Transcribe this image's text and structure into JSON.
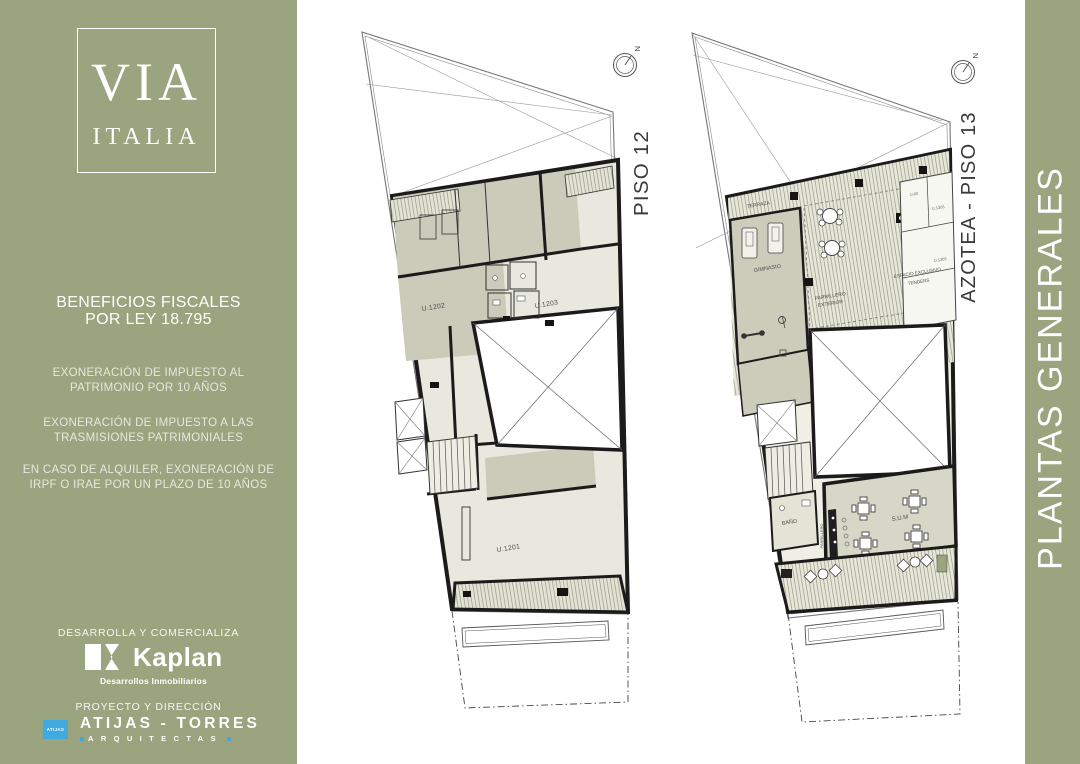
{
  "colors": {
    "panel_green": "#9AA47E",
    "accent_blue": "#3FA9E0",
    "room_dark": "#CBCBBA",
    "room_light": "#E8E8DE",
    "wall": "#1B1B1B"
  },
  "sidebar": {
    "logo_line1": "VIA",
    "logo_line2": "ITALIA",
    "benefits_title_l1": "BENEFICIOS FISCALES",
    "benefits_title_l2": "POR LEY 18.795",
    "benefit_1": "EXONERACIÓN DE IMPUESTO AL PATRIMONIO POR 10 AÑOS",
    "benefit_2": "EXONERACIÓN DE IMPUESTO A LAS TRASMISIONES PATRIMONIALES",
    "benefit_3": "EN CASO DE ALQUILER, EXONERACIÓN DE IRPF O IRAE POR UN PLAZO DE 10 AÑOS",
    "developer_heading": "DESARROLLA Y COMERCIALIZA",
    "kaplan_name": "Kaplan",
    "kaplan_tagline": "Desarrollos Inmobiliarios",
    "architect_heading": "PROYECTO Y DIRECCIÓN",
    "architect_badge": "ATIJAS",
    "architect_name": "ATIJAS - TORRES",
    "architect_tagline": "ARQUITECTAS"
  },
  "right_panel": {
    "title": "PLANTAS GENERALES"
  },
  "plans": {
    "plan1": {
      "caption": "PISO 12",
      "north": "N",
      "units": {
        "u1202": "U.1202",
        "u1203": "U.1203",
        "u1201": "U.1201"
      }
    },
    "plan2": {
      "caption": "AZOTEA - PISO 13",
      "north": "N",
      "rooms": {
        "terraza": "TERRAZA",
        "gimnasio": "GIMNASIO",
        "parrillero_exterior_l1": "PARRILLERO",
        "parrillero_exterior_l2": "EXTERIOR",
        "espacio_l1": "ESPACIO EXCLUSIVO",
        "espacio_l2": "TENDERS",
        "banio": "BAÑO",
        "sum": "S.U.M",
        "parrillero": "PARRILLERO"
      },
      "storage": [
        "U.03",
        "U.1303",
        "U.1303"
      ]
    }
  }
}
